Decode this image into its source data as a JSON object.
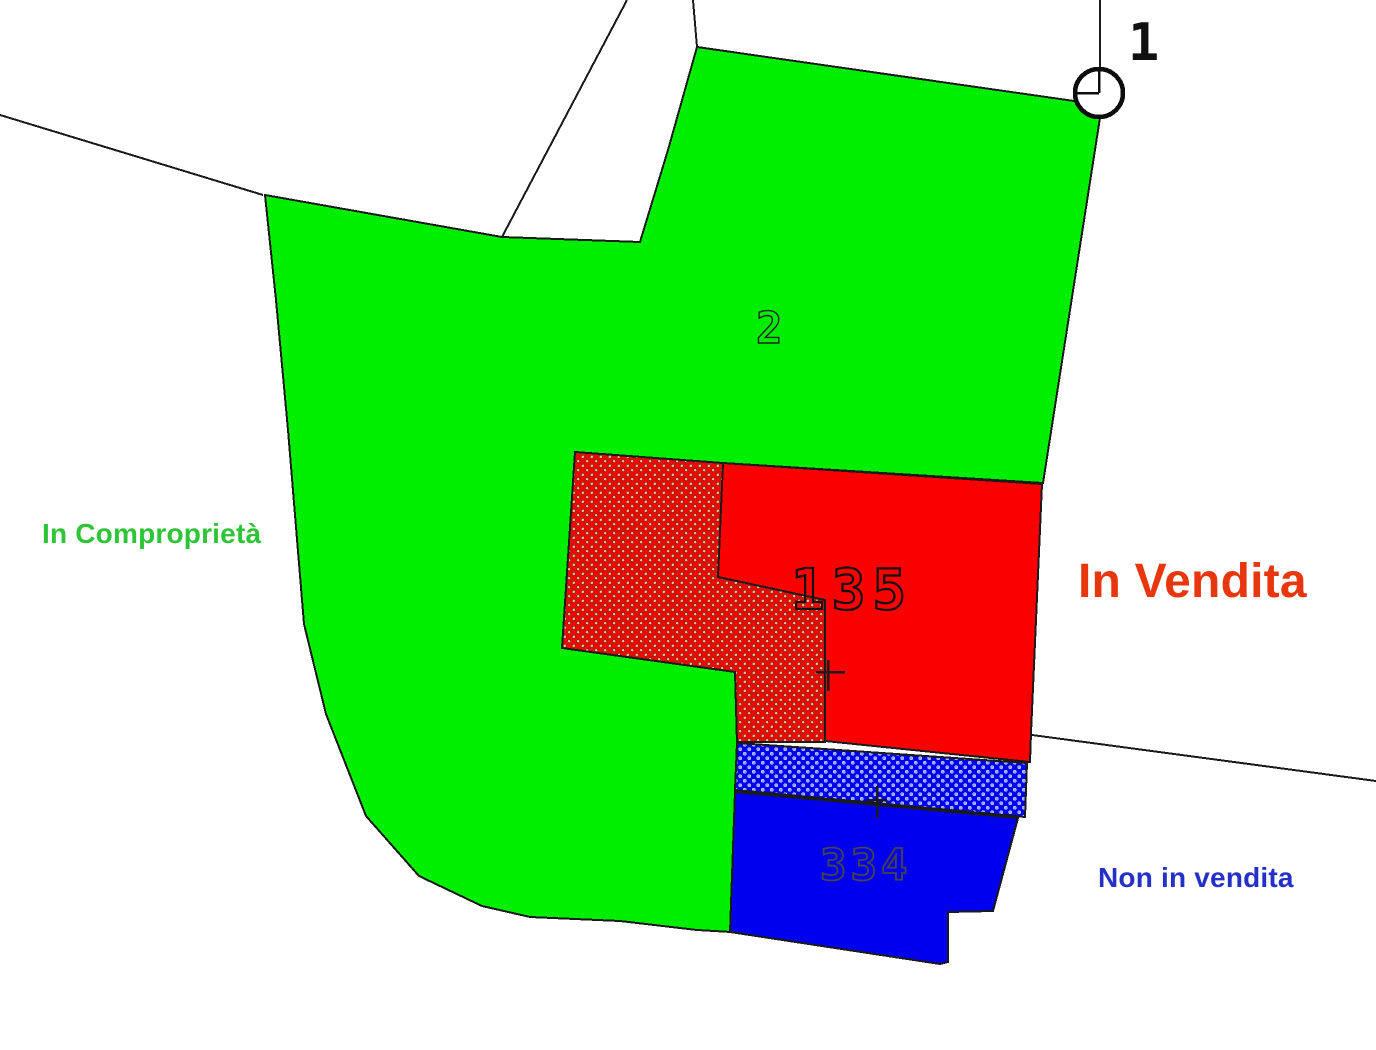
{
  "map": {
    "type": "cadastral-parcel-map",
    "legend": {
      "comproprieta": {
        "text": "In Comproprietà",
        "color": "#2ec437"
      },
      "vendita": {
        "text": "In Vendita",
        "color": "#e8370e"
      },
      "non_vendita": {
        "text": "Non in vendita",
        "color": "#2430c8"
      }
    },
    "parcels": {
      "point_1": {
        "number": "1"
      },
      "parcel_2": {
        "number": "2",
        "status": "In Comproprietà"
      },
      "parcel_135": {
        "number": "135",
        "status": "In Vendita"
      },
      "parcel_334": {
        "number": "334",
        "status": "Non in vendita"
      }
    },
    "colors": {
      "green_fill": "#00ee00",
      "red_fill": "#fa0000",
      "blue_fill": "#0000ee",
      "boundary": "#1a1a1a",
      "number_dark": "#111111",
      "number_gray": "#454545",
      "marker_fill": "#ffffff"
    }
  }
}
